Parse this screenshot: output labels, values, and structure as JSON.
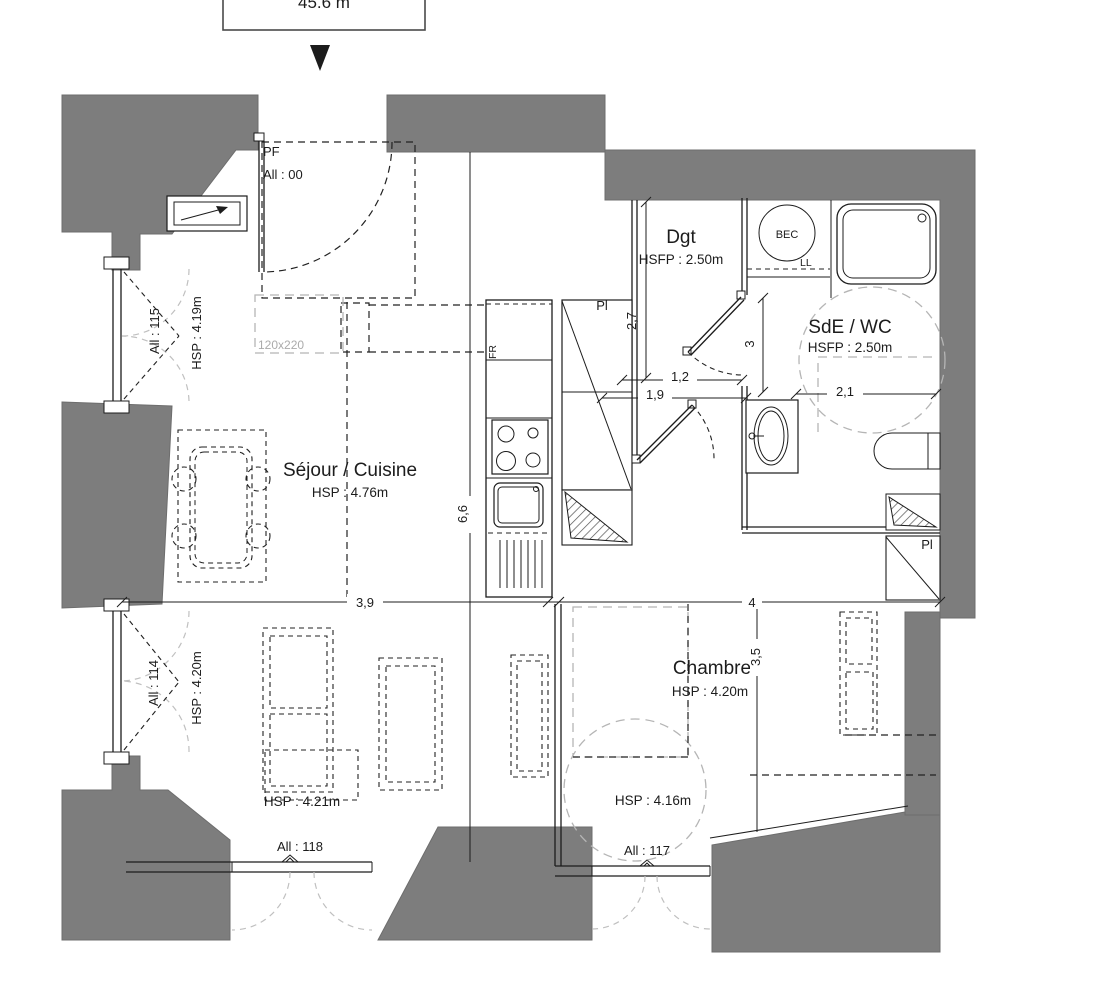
{
  "title_box": {
    "area": "45.6 m"
  },
  "entry": {
    "type": "PF",
    "id": "All : 00"
  },
  "rooms": {
    "living": {
      "name": "Séjour / Cuisine",
      "ceiling": "HSP : 4.76m",
      "zone_ceiling": "HSP : 4.21m"
    },
    "bedroom": {
      "name": "Chambre",
      "ceiling": "HSP : 4.20m",
      "zone_ceiling": "HSP : 4.16m"
    },
    "hall": {
      "name": "Dgt",
      "ceiling": "HSFP : 2.50m"
    },
    "bath": {
      "name": "SdE / WC",
      "ceiling": "HSFP : 2.50m"
    }
  },
  "windows": {
    "w115": {
      "id": "All : 115",
      "ceiling": "HSP : 4.19m"
    },
    "w114": {
      "id": "All : 114",
      "ceiling": "HSP : 4.20m"
    },
    "w118": {
      "id": "All : 118"
    },
    "w117": {
      "id": "All : 117"
    }
  },
  "fixtures": {
    "water_heater": "BEC",
    "washer": "LL",
    "fridge": "FR",
    "closet_kitchen": "Pl",
    "closet_bath": "Pl",
    "skylight": "120x220"
  },
  "dims": {
    "living_depth": "6,6",
    "living_width": "3,9",
    "bedroom_width": "4",
    "hall_depth": "2,7",
    "hall_w1": "1,2",
    "hall_w2": "1,9",
    "bath_depth": "3",
    "bath_width": "2,1",
    "bedroom_depth": "3,5"
  },
  "colors": {
    "wall_gray": "#7d7d7d",
    "line": "#1c1c1c",
    "dash_gray": "#b5b5b5"
  }
}
